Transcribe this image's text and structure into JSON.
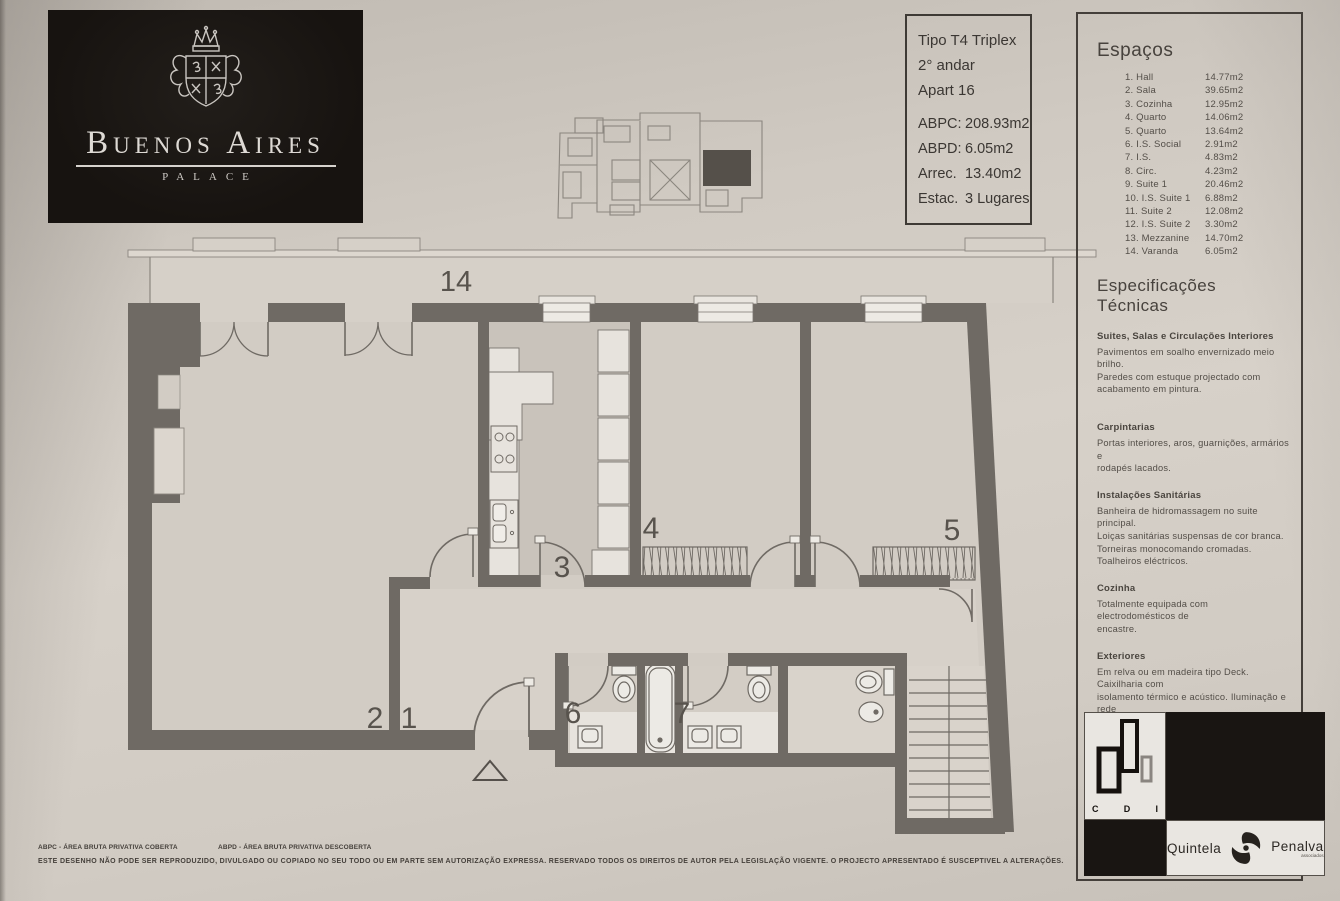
{
  "branding": {
    "name": "Buenos Aires",
    "subtitle": "PALACE"
  },
  "unit_info": {
    "type": "Tipo T4 Triplex",
    "floor": "2° andar",
    "apartment": "Apart 16",
    "metrics": [
      {
        "label": "ABPC:",
        "value": "208.93m2"
      },
      {
        "label": "ABPD:",
        "value": "6.05m2"
      },
      {
        "label": "Arrec.",
        "value": "13.40m2"
      },
      {
        "label": "Estac.",
        "value": "3 Lugares"
      }
    ]
  },
  "spaces": {
    "title": "Espaços",
    "items": [
      {
        "name": "1. Hall",
        "area": "14.77m2"
      },
      {
        "name": "2. Sala",
        "area": "39.65m2"
      },
      {
        "name": "3. Cozinha",
        "area": "12.95m2"
      },
      {
        "name": "4. Quarto",
        "area": "14.06m2"
      },
      {
        "name": "5. Quarto",
        "area": "13.64m2"
      },
      {
        "name": "6. I.S. Social",
        "area": "2.91m2"
      },
      {
        "name": "7. I.S.",
        "area": "4.83m2"
      },
      {
        "name": "8. Circ.",
        "area": "4.23m2"
      },
      {
        "name": "9. Suite 1",
        "area": "20.46m2"
      },
      {
        "name": "10. I.S. Suite 1",
        "area": "6.88m2"
      },
      {
        "name": "11. Suite 2",
        "area": "12.08m2"
      },
      {
        "name": "12. I.S. Suite 2",
        "area": "3.30m2"
      },
      {
        "name": "13. Mezzanine",
        "area": "14.70m2"
      },
      {
        "name": "14. Varanda",
        "area": "6.05m2"
      }
    ]
  },
  "specs": {
    "title": "Especificações Técnicas",
    "sections": [
      {
        "heading": "Suites, Salas e Circulações Interiores",
        "body": "Pavimentos em soalho envernizado meio brilho.\nParedes com estuque projectado com\nacabamento em pintura."
      },
      {
        "heading": "Carpintarias",
        "body": "Portas interiores, aros, guarnições, armários e\nrodapés lacados."
      },
      {
        "heading": "Instalações Sanitárias",
        "body": "Banheira de hidromassagem no suite principal.\nLoiças sanitárias suspensas de cor branca.\nTorneiras monocomando cromadas.\nToalheiros eléctricos."
      },
      {
        "heading": "Cozinha",
        "body": "Totalmente equipada com electrodomésticos de\nencastre."
      },
      {
        "heading": "Exteriores",
        "body": "Em relva ou em madeira tipo Deck. Caixilharia com\nisolamento térmico e acústico. Iluminação e rede\nde rega automatizada nos jardins."
      },
      {
        "heading": "Equipamentos",
        "body": "Sistema Integrado Segurança, Domótica e Video\nporteiro. Sistema de climatização através bomba\ncalor com grelhas de distribuição nas paredes e\ntectos."
      }
    ]
  },
  "plan": {
    "labels": {
      "n1": "1",
      "n2": "2",
      "n3": "3",
      "n4": "4",
      "n5": "5",
      "n6": "6",
      "n7": "7",
      "n14": "14"
    }
  },
  "footer": {
    "legend_abpc": "ABPC - ÁREA BRUTA PRIVATIVA COBERTA",
    "legend_abpd": "ABPD - ÁREA BRUTA PRIVATIVA DESCOBERTA",
    "disclaimer": "ESTE DESENHO NÃO PODE SER REPRODUZIDO, DIVULGADO OU COPIADO NO SEU TODO OU EM PARTE SEM AUTORIZAÇÃO EXPRESSA. RESERVADO TODOS OS DIREITOS DE AUTOR PELA LEGISLAÇÃO VIGENTE. O PROJECTO APRESENTADO É SUSCEPTIVEL A ALTERAÇÕES."
  },
  "logos": {
    "cdi": {
      "letters": [
        "C",
        "D",
        "I"
      ]
    },
    "quintela_penalva": {
      "left": "Quintela",
      "right": "Penalva",
      "sub": "associados"
    }
  },
  "colors": {
    "wall": "#6f6a64",
    "paper": "#d2ccc4",
    "ink": "#45403b",
    "logo_bg": "#171310"
  }
}
